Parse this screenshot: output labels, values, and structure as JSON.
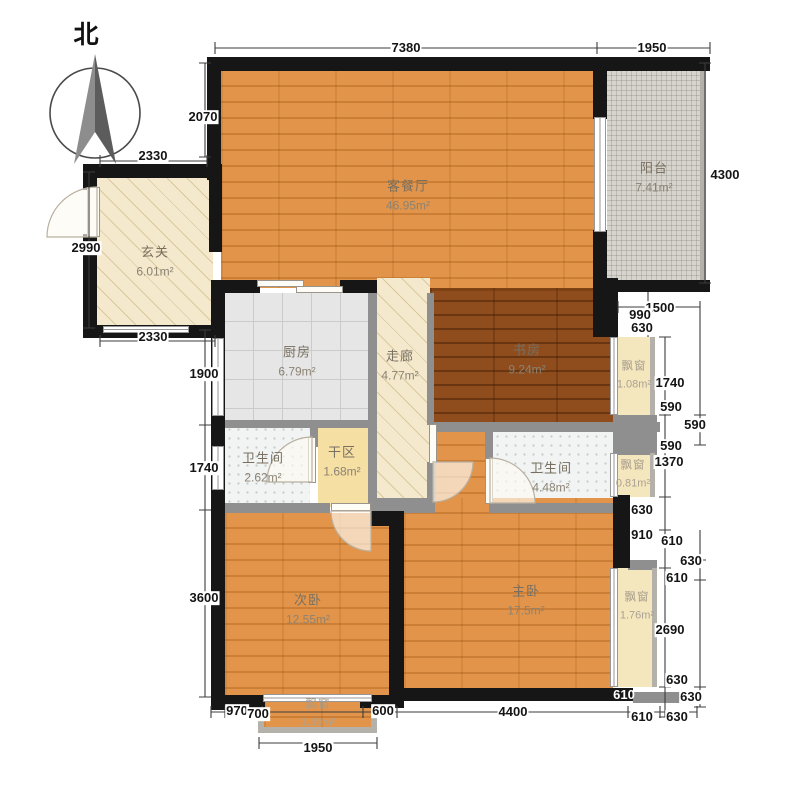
{
  "title": "apartment-floor-plan",
  "compass": {
    "label": "北"
  },
  "rooms": {
    "living": {
      "name": "客餐厅",
      "area": "46.95m²"
    },
    "balcony": {
      "name": "阳台",
      "area": "7.41m²"
    },
    "entry": {
      "name": "玄关",
      "area": "6.01m²"
    },
    "kitchen": {
      "name": "厨房",
      "area": "6.79m²"
    },
    "corridor": {
      "name": "走廊",
      "area": "4.77m²"
    },
    "study": {
      "name": "书房",
      "area": "9.24m²"
    },
    "bath_left": {
      "name": "卫生间",
      "area": "2.62m²"
    },
    "dry_area": {
      "name": "干区",
      "area": "1.68m²"
    },
    "bath_right": {
      "name": "卫生间",
      "area": "4.48m²"
    },
    "bed_second": {
      "name": "次卧",
      "area": "12.55m²"
    },
    "bed_master": {
      "name": "主卧",
      "area": "17.5m²"
    }
  },
  "bays": {
    "study": {
      "name": "飘窗",
      "area": "1.08m²"
    },
    "bath": {
      "name": "飘窗",
      "area": "0.81m²"
    },
    "master": {
      "name": "飘窗",
      "area": "1.76m²"
    },
    "bedroom": {
      "name": "飘窗",
      "area": "1.39m²"
    }
  },
  "dims": [
    "7380",
    "1950",
    "2070",
    "2330",
    "2990",
    "2330",
    "1900",
    "1740",
    "3600",
    "970",
    "700",
    "1950",
    "600",
    "4400",
    "4300",
    "1500",
    "990",
    "630",
    "1740",
    "590",
    "590",
    "590",
    "1370",
    "630",
    "910",
    "610",
    "630",
    "610",
    "2690",
    "630",
    "610",
    "630",
    "610",
    "630"
  ],
  "colors": {
    "wall": "#161616",
    "wood": "#e2954a",
    "study_wood": "#8f4d1d",
    "hatch": "#f4e9cd",
    "tile": "#e6e6e6",
    "bay": "#f5e7bd",
    "balcony": "#d7d4cd",
    "dry": "#f6dfa3"
  }
}
